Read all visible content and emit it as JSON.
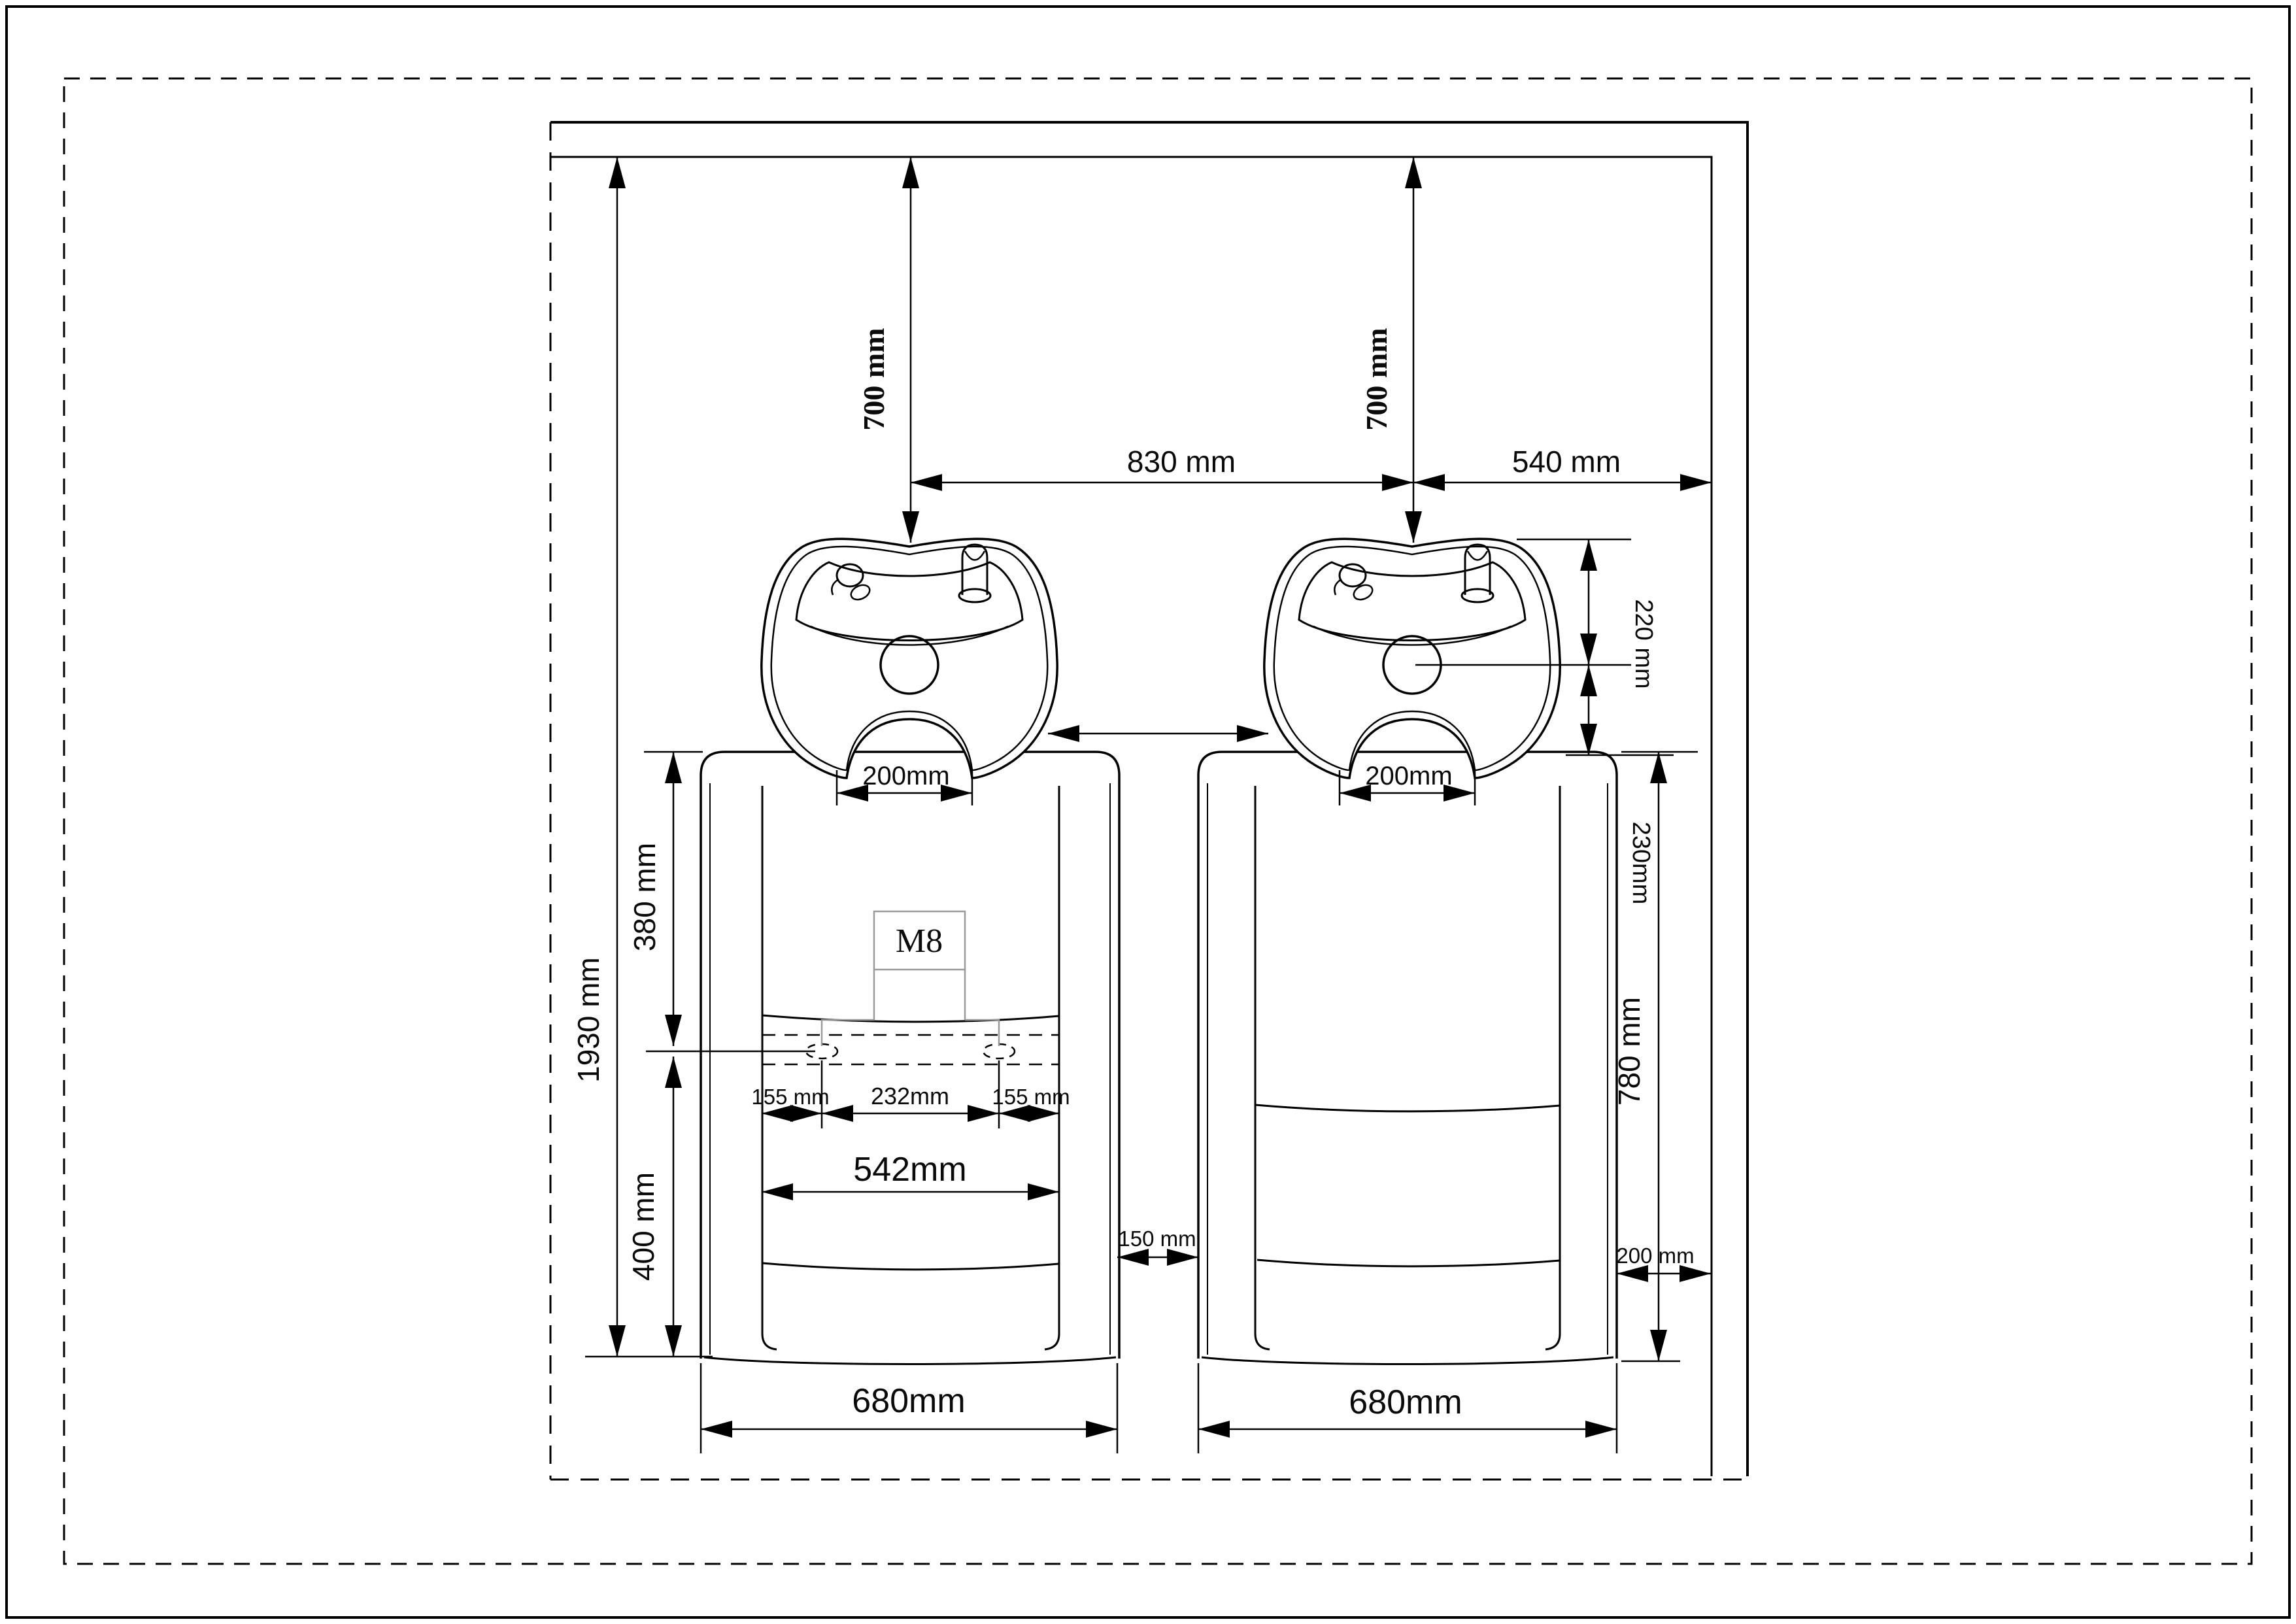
{
  "drawing": {
    "kind": "installation dimension drawing",
    "subject": "twin wall-mounted shampoo backwash basins with seat units",
    "units": "mm"
  },
  "colors": {
    "line": "#000000",
    "bracket_gray": "#9a9a9a",
    "background": "#ffffff"
  },
  "labels": {
    "height_1930": "1930 mm",
    "drop_700_left": "700 mm",
    "drop_700_right": "700 mm",
    "spacing_830": "830 mm",
    "wall_540": "540 mm",
    "basin_220": "220 mm",
    "basin_230": "230mm",
    "neck_200_left": "200mm",
    "neck_200_right": "200mm",
    "back_380": "380 mm",
    "floor_400": "400 mm",
    "bolt_m8": "M8",
    "hole_155_left": "155 mm",
    "hole_232": "232mm",
    "hole_155_right": "155 mm",
    "cushion_542": "542mm",
    "gap_150": "150 mm",
    "wall_200": "200 mm",
    "width_680_left": "680mm",
    "width_680_right": "680mm",
    "seat_780": "780 mm"
  }
}
